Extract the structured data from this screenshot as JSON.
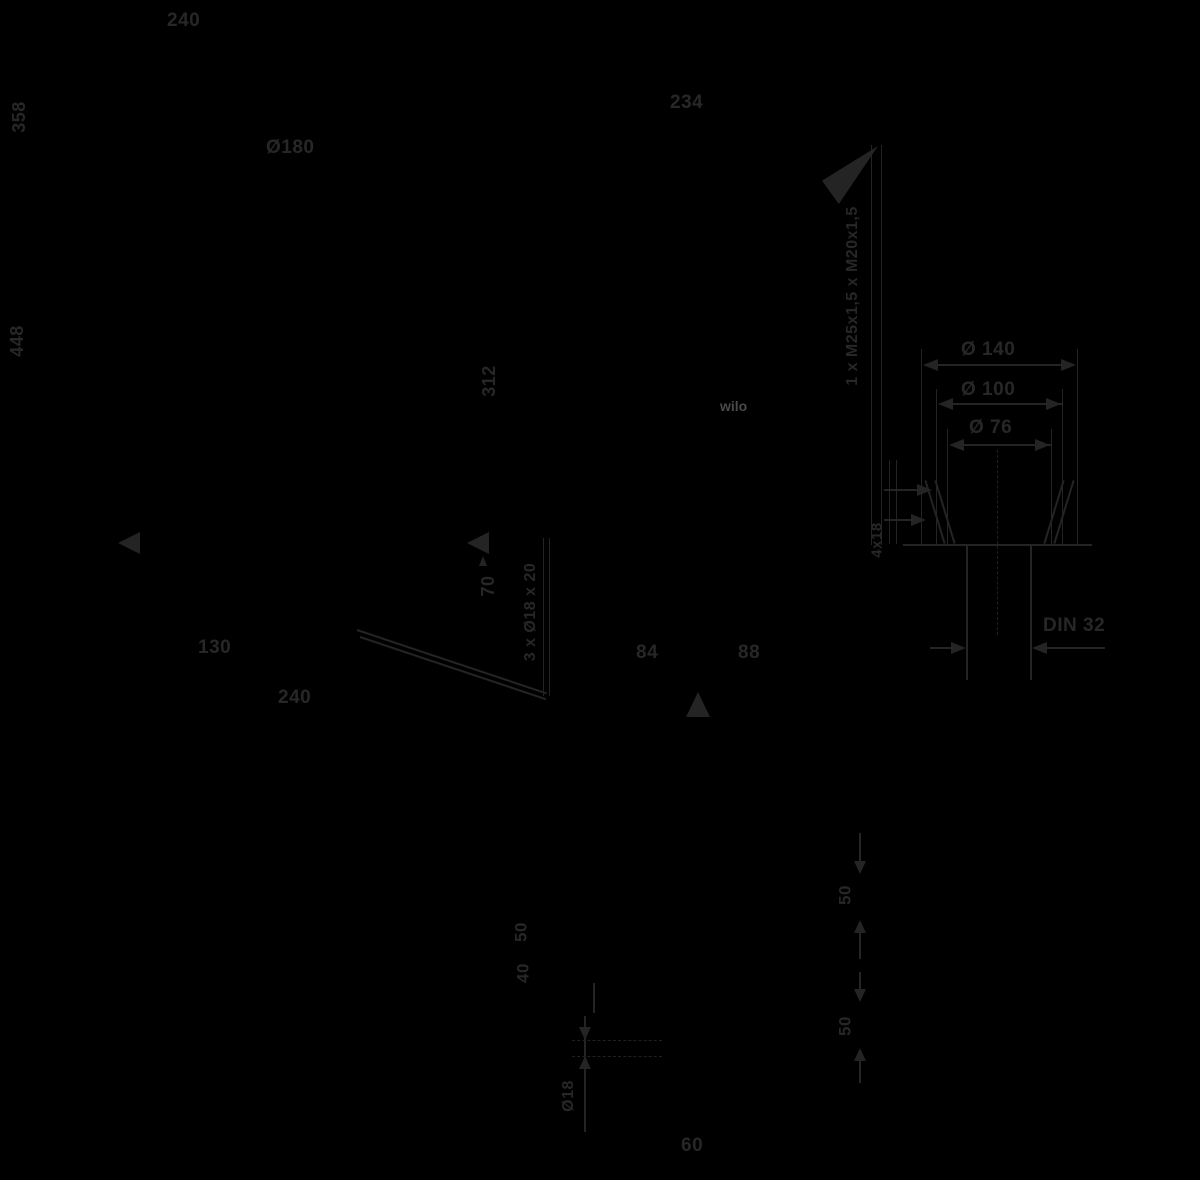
{
  "colors": {
    "background": "#000000",
    "line": "#242424",
    "text": "#272727",
    "logo": "#4a4a4a"
  },
  "brand": {
    "logo": "wilo"
  },
  "labels": {
    "width_top": "240",
    "height_upper": "358",
    "height_total": "448",
    "diameter_body": "Ø180",
    "width_motor": "234",
    "cable_glands": "1 x M25x1,5 x M20x1,5",
    "height_312": "312",
    "height_70": "70",
    "foot_holes": "3 x Ø18 x 20",
    "base_offset": "130",
    "base_width": "240",
    "dim_84": "84",
    "dim_88": "88",
    "flange_od": "Ø 140",
    "flange_bcd": "Ø 100",
    "flange_hub": "Ø 76",
    "flange_holes": "4x18",
    "flange_standard": "DIN 32",
    "dim_50_mid": "50",
    "dim_40": "40",
    "hole_dia": "Ø18",
    "dim_60": "60",
    "dim_50_right_upper": "50",
    "dim_50_right_lower": "50"
  }
}
